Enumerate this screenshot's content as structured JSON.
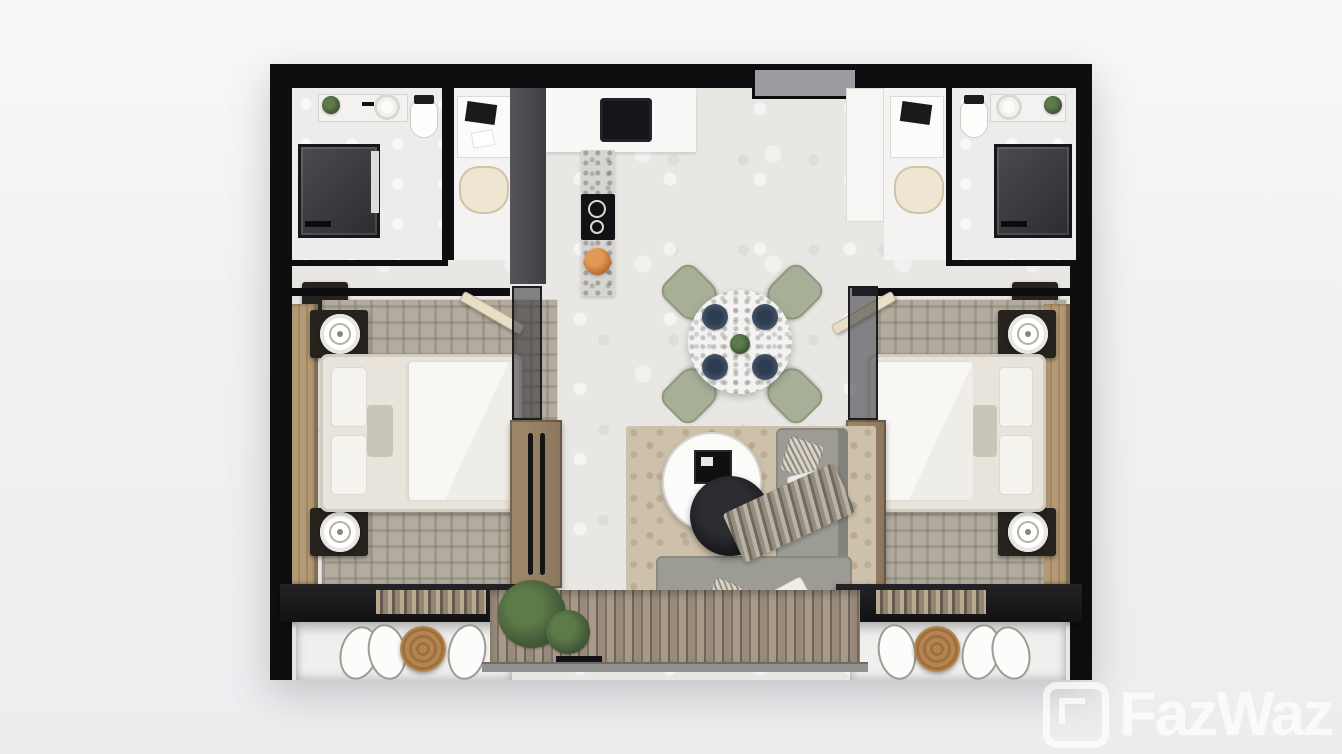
{
  "watermark": {
    "text": "FazWaz",
    "logo": "fazwaz-logo"
  },
  "palette": {
    "wall": "#0e0e10",
    "floor": "#e8e7e4",
    "door": "#9b9ba1",
    "cream": "#e9dfc6",
    "chair": "#efe6d2",
    "sage": "#a7b097",
    "plate": "#46566b",
    "plaid": "#b2ab9e",
    "wood": "#b49a74",
    "bronze": "#8a745c",
    "sofa": "#9c9c95",
    "sofaback": "#83837c",
    "rugbeige": "#cdc1ab",
    "deck1": "#998b7b",
    "deck2": "#a89a88",
    "rail": "#90908e",
    "plant": "#3f5435",
    "basket": "#b5854f",
    "wm": "rgba(255,255,255,0.72)"
  },
  "scene": {
    "type": "3d-top-view-floor-plan",
    "unit": "two-bedroom two-bathroom apartment with central living-dining-kitchen and balcony",
    "rooms": [
      {
        "name": "bathroom-left",
        "furniture": [
          "shower",
          "vanity-sink",
          "faucet",
          "toilet",
          "plant"
        ]
      },
      {
        "name": "desk-nook-left",
        "furniture": [
          "desk",
          "laptop",
          "papers",
          "cream-chair"
        ]
      },
      {
        "name": "kitchen",
        "furniture": [
          "white-counter",
          "black-sink",
          "marble-counter",
          "induction-cooktop",
          "fruit-bowl"
        ]
      },
      {
        "name": "entrance-foyer",
        "furniture": [
          "entry-door",
          "white-closet-column"
        ]
      },
      {
        "name": "desk-nook-right",
        "furniture": [
          "desk",
          "laptop",
          "cream-chair"
        ]
      },
      {
        "name": "bathroom-right",
        "furniture": [
          "toilet",
          "vanity-sink",
          "plant",
          "shower"
        ]
      },
      {
        "name": "bedroom-left",
        "furniture": [
          "double-bed",
          "white-duvet",
          "pillows",
          "nightstand-with-lamp",
          "nightstand-with-lamp",
          "plaid-rug",
          "wood-accent-headboard-wall",
          "wall-shelf"
        ]
      },
      {
        "name": "bedroom-right",
        "furniture": [
          "double-bed",
          "white-duvet",
          "pillows",
          "nightstand-with-lamp",
          "nightstand-with-lamp",
          "plaid-rug",
          "wood-accent-headboard-wall",
          "wall-shelf"
        ]
      },
      {
        "name": "dining-area",
        "furniture": [
          "round-marble-table",
          "sage-chair",
          "sage-chair",
          "sage-chair",
          "sage-chair",
          "navy-plate-x4",
          "centerpiece-plant"
        ]
      },
      {
        "name": "living-room",
        "furniture": [
          "l-shaped-gray-sofa",
          "throw-pillows",
          "patterned-throw-blanket",
          "round-nesting-coffee-tables",
          "framed-tray-decor",
          "beige-area-rug",
          "bronze-glass-cabinet",
          "bronze-glass-cabinet"
        ]
      },
      {
        "name": "wardrobe-left",
        "furniture": [
          "dark-counter",
          "scarves",
          "hanging-clothes",
          "woven-basket"
        ]
      },
      {
        "name": "wardrobe-right",
        "furniture": [
          "dark-counter",
          "scarves",
          "hanging-clothes",
          "woven-basket"
        ]
      },
      {
        "name": "balcony",
        "furniture": [
          "wood-deck",
          "potted-plants",
          "planter-box",
          "glass-railing"
        ]
      }
    ]
  }
}
